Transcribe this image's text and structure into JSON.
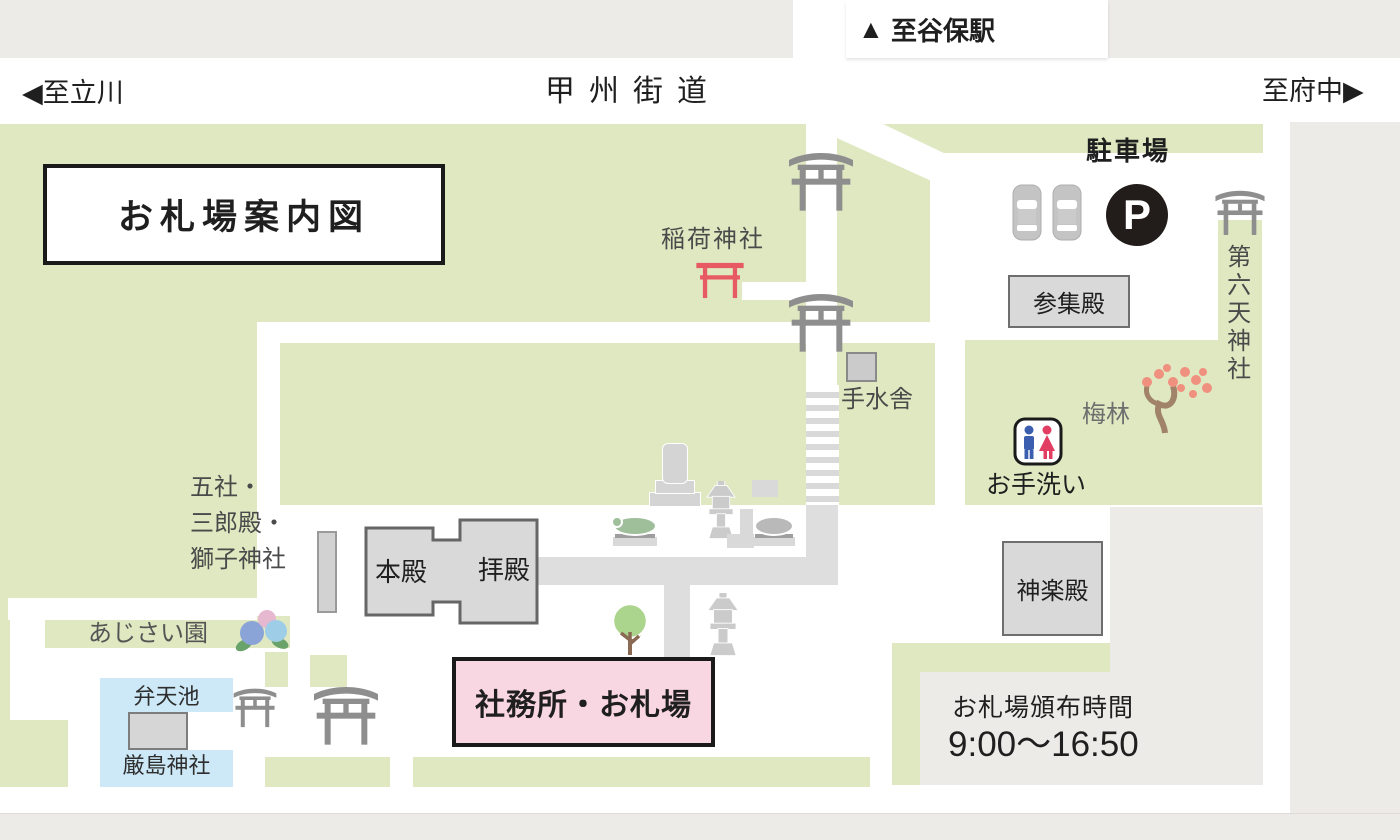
{
  "map": {
    "title": "お札場案内図",
    "roads": {
      "koshu_kaido": "甲州街道",
      "to_tachikawa": "至立川",
      "to_fuchu": "至府中",
      "to_yaho_station": "至谷保駅",
      "left_arrow": "◀",
      "right_arrow": "▶",
      "up_arrow": "▲"
    },
    "places": {
      "inari": "稲荷神社",
      "parking": "駐車場",
      "parking_p": "P",
      "sanshuden": "参集殿",
      "dairokuten": "第六天神社",
      "temizusha": "手水舎",
      "bairin": "梅林",
      "toilet": "お手洗い",
      "gosha_line1": "五社・",
      "gosha_line2": "三郎殿・",
      "gosha_line3": "獅子神社",
      "honden": "本殿",
      "haiden": "拝殿",
      "kaguraden": "神楽殿",
      "ajisai": "あじさい園",
      "bentenike": "弁天池",
      "itsukushima": "厳島神社",
      "shamusho": "社務所・お札場",
      "hours_label": "お札場頒布時間",
      "hours_value": "9:00〜16:50"
    },
    "colors": {
      "green": "#dfe8c1",
      "bar_gray": "#ecebe8",
      "building_gray": "#d9d9d9",
      "path_gray": "#dedede",
      "pink": "#f8d6e2",
      "pond_blue": "#cde9f7",
      "torii_gray": "#8e8e8e",
      "torii_red": "#e85a63",
      "p_black": "#221d1a",
      "man_blue": "#3b5fae",
      "woman_red": "#e23e63"
    }
  }
}
